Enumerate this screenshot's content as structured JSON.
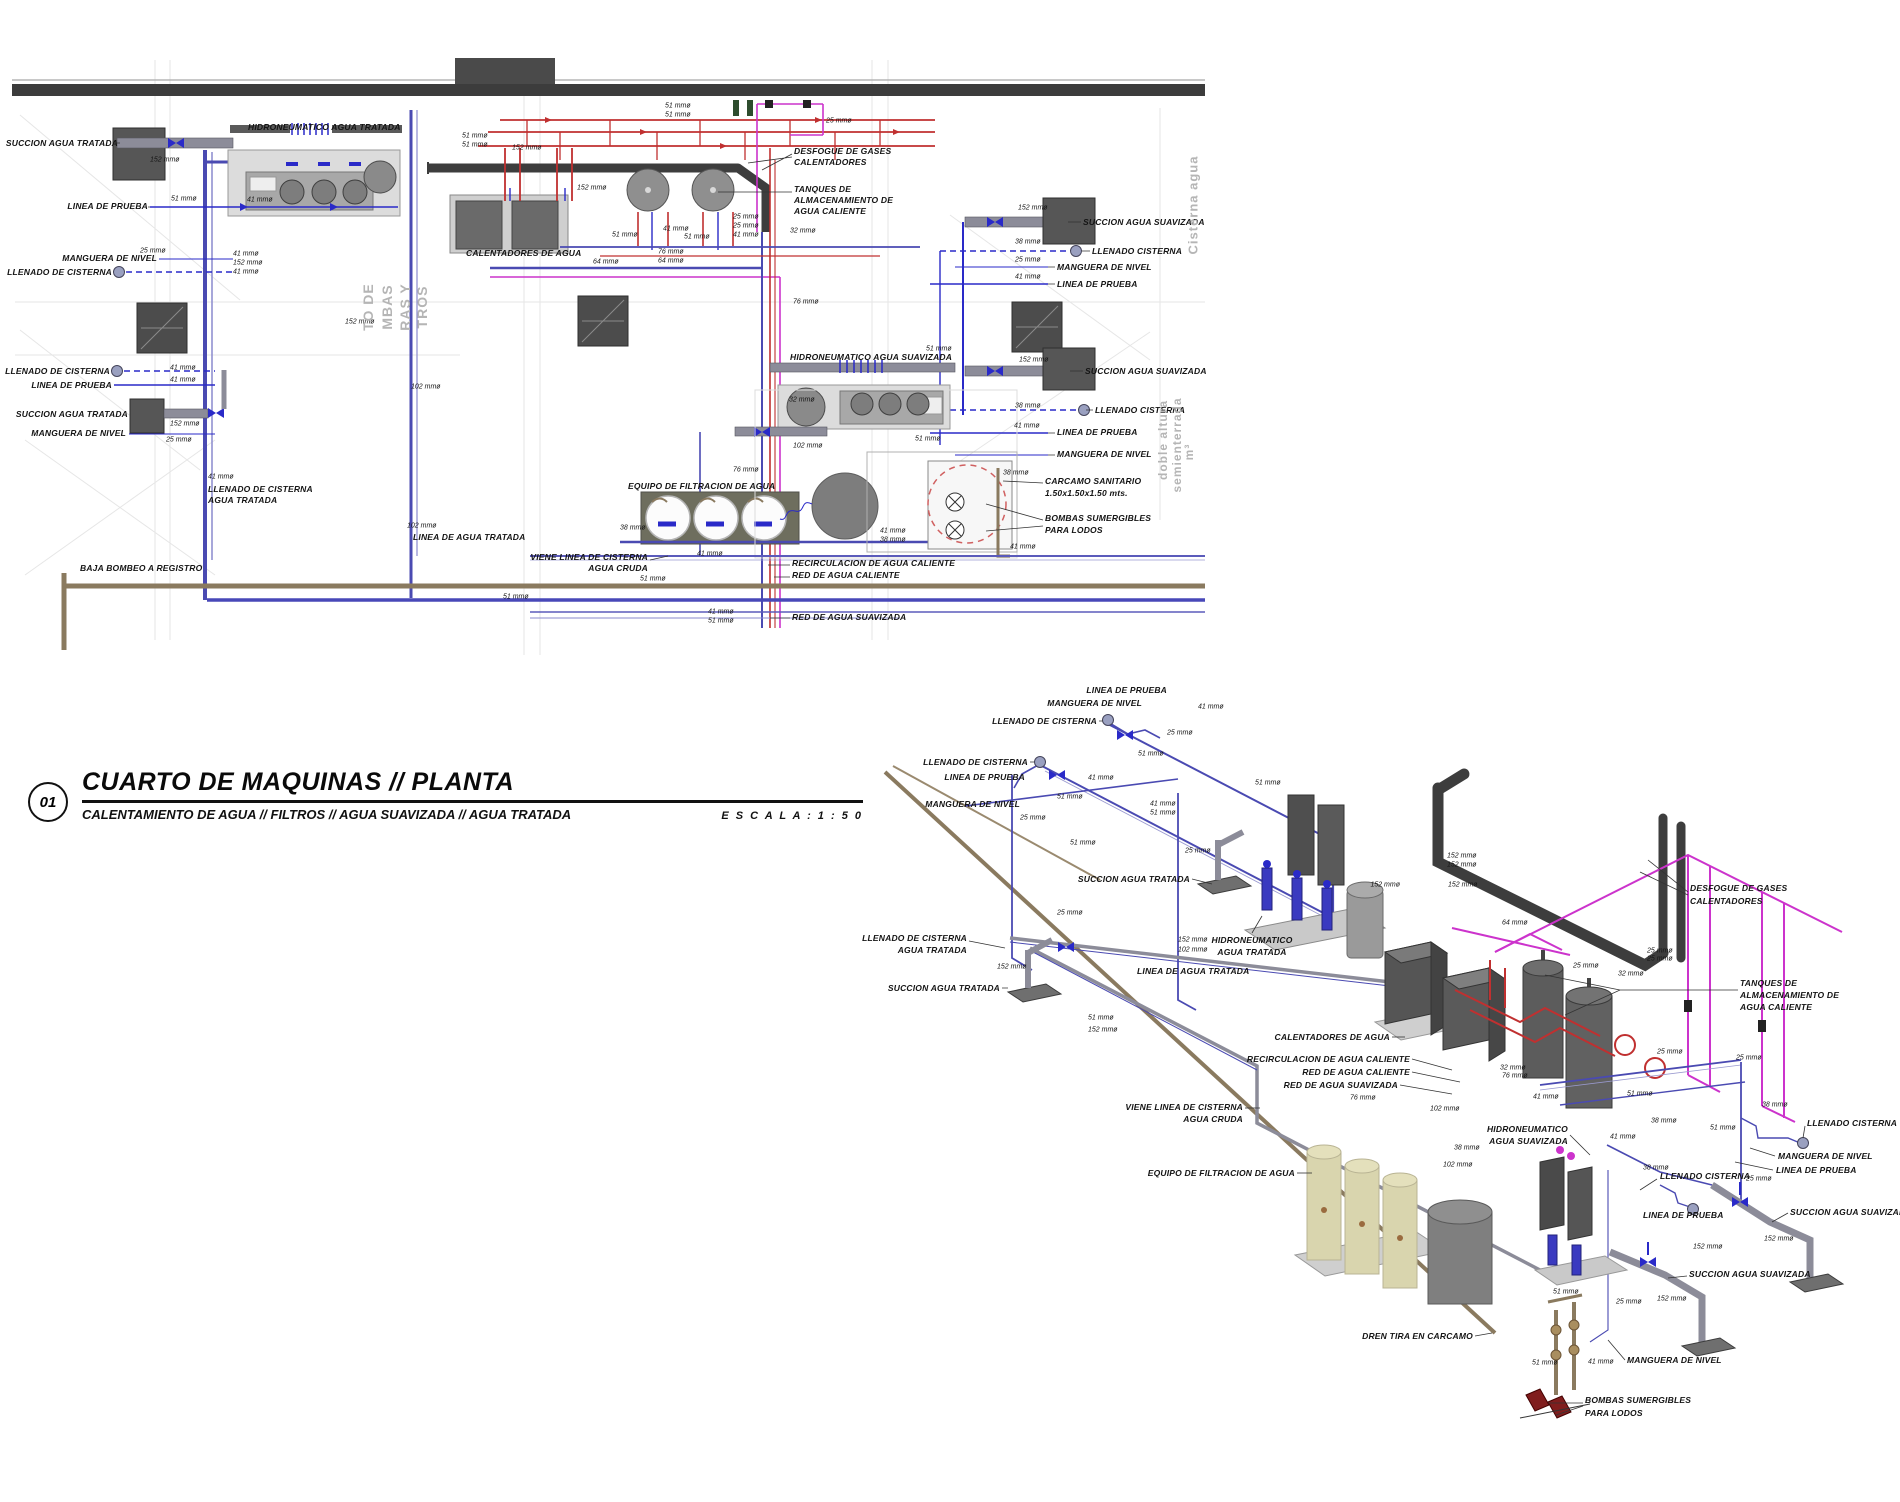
{
  "title_block": {
    "number": "01",
    "title": "CUARTO DE MAQUINAS  //  PLANTA",
    "subtitle": "CALENTAMIENTO DE AGUA // FILTROS // AGUA SUAVIZADA // AGUA TRATADA",
    "scale_label": "E S C A L A :   1 : 5 0"
  },
  "legend_colors": {
    "cold_water_pipe": "#4a4ab2",
    "hot_water_pipe": "#c03030",
    "hot_water_return_pipe": "#cc33cc",
    "drain_pipe": "#8a7a5f",
    "flue_gas_pipe": "#3d3d3d"
  },
  "plan_view": {
    "labels": [
      {
        "t": "HIDRONEUMATICO AGUA TRATADA",
        "x": 248,
        "y": 127,
        "a": "s"
      },
      {
        "t": "SUCCION AGUA TRATADA",
        "x": 118,
        "y": 143,
        "a": "e"
      },
      {
        "t": "LINEA DE PRUEBA",
        "x": 148,
        "y": 206,
        "a": "e"
      },
      {
        "t": "MANGUERA DE NIVEL",
        "x": 157,
        "y": 258,
        "a": "e"
      },
      {
        "t": "LLENADO DE CISTERNA",
        "x": 112,
        "y": 272,
        "a": "e"
      },
      {
        "t": "LLENADO DE CISTERNA",
        "x": 110,
        "y": 371,
        "a": "e"
      },
      {
        "t": "LINEA DE PRUEBA",
        "x": 112,
        "y": 385,
        "a": "e"
      },
      {
        "t": "SUCCION AGUA TRATADA",
        "x": 128,
        "y": 414,
        "a": "e"
      },
      {
        "t": "MANGUERA DE NIVEL",
        "x": 126,
        "y": 433,
        "a": "e"
      },
      {
        "t": "LLENADO DE CISTERNA",
        "x": 208,
        "y": 489,
        "a": "s"
      },
      {
        "t": "AGUA TRATADA",
        "x": 208,
        "y": 500,
        "a": "s"
      },
      {
        "t": "LINEA DE AGUA TRATADA",
        "x": 413,
        "y": 537,
        "a": "s"
      },
      {
        "t": "BAJA BOMBEO A REGISTRO",
        "x": 80,
        "y": 568,
        "a": "s"
      },
      {
        "t": "CALENTADORES DE AGUA",
        "x": 466,
        "y": 253,
        "a": "s"
      },
      {
        "t": "DESFOGUE DE GASES",
        "x": 794,
        "y": 151,
        "a": "s"
      },
      {
        "t": "CALENTADORES",
        "x": 794,
        "y": 162,
        "a": "s"
      },
      {
        "t": "TANQUES DE",
        "x": 794,
        "y": 189,
        "a": "s"
      },
      {
        "t": "ALMACENAMIENTO DE",
        "x": 794,
        "y": 200,
        "a": "s"
      },
      {
        "t": "AGUA CALIENTE",
        "x": 794,
        "y": 211,
        "a": "s"
      },
      {
        "t": "HIDRONEUMATICO AGUA SUAVIZADA",
        "x": 790,
        "y": 357,
        "a": "s"
      },
      {
        "t": "SUCCION AGUA SUAVIZADA",
        "x": 1083,
        "y": 222,
        "a": "s"
      },
      {
        "t": "LLENADO CISTERNA",
        "x": 1092,
        "y": 251,
        "a": "s"
      },
      {
        "t": "MANGUERA DE NIVEL",
        "x": 1057,
        "y": 267,
        "a": "s"
      },
      {
        "t": "LINEA DE PRUEBA",
        "x": 1057,
        "y": 284,
        "a": "s"
      },
      {
        "t": "SUCCION AGUA SUAVIZADA",
        "x": 1085,
        "y": 371,
        "a": "s"
      },
      {
        "t": "LLENADO CISTERNA",
        "x": 1095,
        "y": 410,
        "a": "s"
      },
      {
        "t": "LINEA DE PRUEBA",
        "x": 1057,
        "y": 432,
        "a": "s"
      },
      {
        "t": "MANGUERA DE NIVEL",
        "x": 1057,
        "y": 454,
        "a": "s"
      },
      {
        "t": "CARCAMO SANITARIO",
        "x": 1045,
        "y": 481,
        "a": "s"
      },
      {
        "t": "1.50x1.50x1.50 mts.",
        "x": 1045,
        "y": 493,
        "a": "s"
      },
      {
        "t": "BOMBAS SUMERGIBLES",
        "x": 1045,
        "y": 518,
        "a": "s"
      },
      {
        "t": "PARA LODOS",
        "x": 1045,
        "y": 530,
        "a": "s"
      },
      {
        "t": "EQUIPO DE FILTRACION DE AGUA",
        "x": 628,
        "y": 486,
        "a": "s"
      },
      {
        "t": "VIENE LINEA DE CISTERNA",
        "x": 648,
        "y": 557,
        "a": "e"
      },
      {
        "t": "AGUA CRUDA",
        "x": 648,
        "y": 568,
        "a": "e"
      },
      {
        "t": "RECIRCULACION DE AGUA CALIENTE",
        "x": 792,
        "y": 563,
        "a": "s"
      },
      {
        "t": "RED DE AGUA CALIENTE",
        "x": 792,
        "y": 575,
        "a": "s"
      },
      {
        "t": "RED DE AGUA SUAVIZADA",
        "x": 792,
        "y": 617,
        "a": "s"
      }
    ],
    "dims": [
      {
        "t": "152 mmø",
        "x": 150,
        "y": 160
      },
      {
        "t": "51 mmø",
        "x": 171,
        "y": 199
      },
      {
        "t": "41 mmø",
        "x": 247,
        "y": 200
      },
      {
        "t": "25 mmø",
        "x": 140,
        "y": 251
      },
      {
        "t": "41 mmø",
        "x": 233,
        "y": 254
      },
      {
        "t": "152 mmø",
        "x": 233,
        "y": 263
      },
      {
        "t": "41 mmø",
        "x": 233,
        "y": 272
      },
      {
        "t": "41 mmø",
        "x": 170,
        "y": 368
      },
      {
        "t": "41 mmø",
        "x": 170,
        "y": 380
      },
      {
        "t": "152 mmø",
        "x": 170,
        "y": 424
      },
      {
        "t": "25 mmø",
        "x": 166,
        "y": 440
      },
      {
        "t": "152 mmø",
        "x": 345,
        "y": 322
      },
      {
        "t": "102 mmø",
        "x": 411,
        "y": 387
      },
      {
        "t": "41 mmø",
        "x": 208,
        "y": 477
      },
      {
        "t": "102 mmø",
        "x": 407,
        "y": 526
      },
      {
        "t": "51 mmø",
        "x": 462,
        "y": 136
      },
      {
        "t": "51 mmø",
        "x": 462,
        "y": 145
      },
      {
        "t": "152 mmø",
        "x": 512,
        "y": 148
      },
      {
        "t": "152 mmø",
        "x": 577,
        "y": 188
      },
      {
        "t": "51 mmø",
        "x": 665,
        "y": 106
      },
      {
        "t": "51 mmø",
        "x": 665,
        "y": 115
      },
      {
        "t": "25 mmø",
        "x": 826,
        "y": 121
      },
      {
        "t": "51 mmø",
        "x": 612,
        "y": 235
      },
      {
        "t": "41 mmø",
        "x": 663,
        "y": 229
      },
      {
        "t": "51 mmø",
        "x": 684,
        "y": 237
      },
      {
        "t": "25 mmø",
        "x": 733,
        "y": 217
      },
      {
        "t": "25 mmø",
        "x": 733,
        "y": 226
      },
      {
        "t": "41 mmø",
        "x": 733,
        "y": 235
      },
      {
        "t": "32 mmø",
        "x": 790,
        "y": 231
      },
      {
        "t": "64 mmø",
        "x": 593,
        "y": 262
      },
      {
        "t": "76 mmø",
        "x": 658,
        "y": 252
      },
      {
        "t": "64 mmø",
        "x": 658,
        "y": 261
      },
      {
        "t": "76 mmø",
        "x": 793,
        "y": 302
      },
      {
        "t": "76 mmø",
        "x": 733,
        "y": 470
      },
      {
        "t": "51 mmø",
        "x": 926,
        "y": 349
      },
      {
        "t": "152 mmø",
        "x": 1018,
        "y": 208
      },
      {
        "t": "38 mmø",
        "x": 1015,
        "y": 242
      },
      {
        "t": "25 mmø",
        "x": 1015,
        "y": 260
      },
      {
        "t": "41 mmø",
        "x": 1015,
        "y": 277
      },
      {
        "t": "152 mmø",
        "x": 1019,
        "y": 360
      },
      {
        "t": "38 mmø",
        "x": 1015,
        "y": 406
      },
      {
        "t": "41 mmø",
        "x": 1014,
        "y": 426
      },
      {
        "t": "32 mmø",
        "x": 789,
        "y": 400
      },
      {
        "t": "102 mmø",
        "x": 793,
        "y": 446
      },
      {
        "t": "51 mmø",
        "x": 915,
        "y": 439
      },
      {
        "t": "38 mmø",
        "x": 1003,
        "y": 473
      },
      {
        "t": "41 mmø",
        "x": 880,
        "y": 531
      },
      {
        "t": "38 mmø",
        "x": 880,
        "y": 540
      },
      {
        "t": "41 mmø",
        "x": 1010,
        "y": 547
      },
      {
        "t": "38 mmø",
        "x": 620,
        "y": 528
      },
      {
        "t": "41 mmø",
        "x": 697,
        "y": 554
      },
      {
        "t": "51 mmø",
        "x": 640,
        "y": 579
      },
      {
        "t": "51 mmø",
        "x": 503,
        "y": 597
      },
      {
        "t": "41 mmø",
        "x": 708,
        "y": 612
      },
      {
        "t": "51 mmø",
        "x": 708,
        "y": 621
      }
    ],
    "room_texts": [
      {
        "t": "TO DE",
        "x": 368,
        "y": 307,
        "r": -90,
        "s": 14
      },
      {
        "t": "MBAS",
        "x": 387,
        "y": 307,
        "r": -90,
        "s": 14
      },
      {
        "t": "RAS Y",
        "x": 405,
        "y": 307,
        "r": -90,
        "s": 14
      },
      {
        "t": "TROS",
        "x": 422,
        "y": 307,
        "r": -90,
        "s": 14
      },
      {
        "t": "Cisterna agua",
        "x": 1193,
        "y": 205,
        "r": -90,
        "s": 13
      },
      {
        "t": "doble altura",
        "x": 1163,
        "y": 440,
        "r": -90,
        "s": 12
      },
      {
        "t": "semienterrada",
        "x": 1177,
        "y": 445,
        "r": -90,
        "s": 12
      },
      {
        "t": "m³",
        "x": 1189,
        "y": 452,
        "r": -90,
        "s": 12
      }
    ]
  },
  "iso_view": {
    "labels": [
      {
        "t": "LINEA DE PRUEBA",
        "x": 1167,
        "y": 690,
        "a": "e"
      },
      {
        "t": "MANGUERA DE NIVEL",
        "x": 1142,
        "y": 703,
        "a": "e"
      },
      {
        "t": "LLENADO DE CISTERNA",
        "x": 1097,
        "y": 721,
        "a": "e"
      },
      {
        "t": "LLENADO DE CISTERNA",
        "x": 1028,
        "y": 762,
        "a": "e"
      },
      {
        "t": "LINEA DE PRUEBA",
        "x": 1025,
        "y": 777,
        "a": "e"
      },
      {
        "t": "MANGUERA DE NIVEL",
        "x": 1020,
        "y": 804,
        "a": "e"
      },
      {
        "t": "SUCCION AGUA TRATADA",
        "x": 1190,
        "y": 879,
        "a": "e"
      },
      {
        "t": "HIDRONEUMATICO",
        "x": 1252,
        "y": 940,
        "a": "c"
      },
      {
        "t": "AGUA TRATADA",
        "x": 1252,
        "y": 952,
        "a": "c"
      },
      {
        "t": "LLENADO DE CISTERNA",
        "x": 967,
        "y": 938,
        "a": "e"
      },
      {
        "t": "AGUA TRATADA",
        "x": 967,
        "y": 950,
        "a": "e"
      },
      {
        "t": "SUCCION AGUA TRATADA",
        "x": 1000,
        "y": 988,
        "a": "e"
      },
      {
        "t": "LINEA DE AGUA TRATADA",
        "x": 1137,
        "y": 971,
        "a": "s"
      },
      {
        "t": "DESFOGUE DE GASES",
        "x": 1690,
        "y": 888,
        "a": "s"
      },
      {
        "t": "CALENTADORES",
        "x": 1690,
        "y": 901,
        "a": "s"
      },
      {
        "t": "TANQUES DE",
        "x": 1740,
        "y": 983,
        "a": "s"
      },
      {
        "t": "ALMACENAMIENTO DE",
        "x": 1740,
        "y": 995,
        "a": "s"
      },
      {
        "t": "AGUA CALIENTE",
        "x": 1740,
        "y": 1007,
        "a": "s"
      },
      {
        "t": "CALENTADORES DE AGUA",
        "x": 1390,
        "y": 1037,
        "a": "e"
      },
      {
        "t": "RECIRCULACION DE AGUA CALIENTE",
        "x": 1410,
        "y": 1059,
        "a": "e"
      },
      {
        "t": "RED DE AGUA CALIENTE",
        "x": 1410,
        "y": 1072,
        "a": "e"
      },
      {
        "t": "RED DE AGUA SUAVIZADA",
        "x": 1398,
        "y": 1085,
        "a": "e"
      },
      {
        "t": "VIENE LINEA DE CISTERNA",
        "x": 1243,
        "y": 1107,
        "a": "e"
      },
      {
        "t": "AGUA CRUDA",
        "x": 1243,
        "y": 1119,
        "a": "e"
      },
      {
        "t": "EQUIPO DE FILTRACION DE AGUA",
        "x": 1295,
        "y": 1173,
        "a": "e"
      },
      {
        "t": "HIDRONEUMATICO",
        "x": 1568,
        "y": 1129,
        "a": "e"
      },
      {
        "t": "AGUA SUAVIZADA",
        "x": 1568,
        "y": 1141,
        "a": "e"
      },
      {
        "t": "LLENADO CISTERNA",
        "x": 1807,
        "y": 1123,
        "a": "s"
      },
      {
        "t": "MANGUERA DE NIVEL",
        "x": 1778,
        "y": 1156,
        "a": "s"
      },
      {
        "t": "LINEA DE PRUEBA",
        "x": 1776,
        "y": 1170,
        "a": "s"
      },
      {
        "t": "LLENADO CISTERNA",
        "x": 1660,
        "y": 1176,
        "a": "s"
      },
      {
        "t": "LINEA DE PRUEBA",
        "x": 1643,
        "y": 1215,
        "a": "s"
      },
      {
        "t": "SUCCION AGUA SUAVIZADA",
        "x": 1790,
        "y": 1212,
        "a": "s"
      },
      {
        "t": "SUCCION AGUA SUAVIZADA",
        "x": 1689,
        "y": 1274,
        "a": "s"
      },
      {
        "t": "MANGUERA DE NIVEL",
        "x": 1627,
        "y": 1360,
        "a": "s"
      },
      {
        "t": "DREN TIRA EN CARCAMO",
        "x": 1473,
        "y": 1336,
        "a": "e"
      },
      {
        "t": "BOMBAS SUMERGIBLES",
        "x": 1585,
        "y": 1400,
        "a": "s"
      },
      {
        "t": "PARA LODOS",
        "x": 1585,
        "y": 1413,
        "a": "s"
      }
    ],
    "dims": [
      {
        "t": "41 mmø",
        "x": 1198,
        "y": 707
      },
      {
        "t": "25 mmø",
        "x": 1167,
        "y": 733
      },
      {
        "t": "51 mmø",
        "x": 1138,
        "y": 754
      },
      {
        "t": "41 mmø",
        "x": 1088,
        "y": 778
      },
      {
        "t": "51 mmø",
        "x": 1057,
        "y": 797
      },
      {
        "t": "41 mmø",
        "x": 1150,
        "y": 804
      },
      {
        "t": "51 mmø",
        "x": 1150,
        "y": 813
      },
      {
        "t": "25 mmø",
        "x": 1020,
        "y": 818
      },
      {
        "t": "51 mmø",
        "x": 1070,
        "y": 843
      },
      {
        "t": "25 mmø",
        "x": 1185,
        "y": 851
      },
      {
        "t": "51 mmø",
        "x": 1255,
        "y": 783
      },
      {
        "t": "25 mmø",
        "x": 1057,
        "y": 913
      },
      {
        "t": "152 mmø",
        "x": 1178,
        "y": 940
      },
      {
        "t": "102 mmø",
        "x": 1178,
        "y": 950
      },
      {
        "t": "152 mmø",
        "x": 997,
        "y": 967
      },
      {
        "t": "51 mmø",
        "x": 1088,
        "y": 1018
      },
      {
        "t": "152 mmø",
        "x": 1088,
        "y": 1030
      },
      {
        "t": "152 mmø",
        "x": 1447,
        "y": 856
      },
      {
        "t": "152 mmø",
        "x": 1447,
        "y": 865
      },
      {
        "t": "152 mmø",
        "x": 1400,
        "y": 885,
        "a": "e"
      },
      {
        "t": "152 mmø",
        "x": 1448,
        "y": 885
      },
      {
        "t": "64 mmø",
        "x": 1502,
        "y": 923
      },
      {
        "t": "25 mmø",
        "x": 1573,
        "y": 966
      },
      {
        "t": "32 mmø",
        "x": 1618,
        "y": 974
      },
      {
        "t": "25 mmø",
        "x": 1647,
        "y": 951
      },
      {
        "t": "25 mmø",
        "x": 1647,
        "y": 959
      },
      {
        "t": "25 mmø",
        "x": 1657,
        "y": 1052
      },
      {
        "t": "25 mmø",
        "x": 1736,
        "y": 1058
      },
      {
        "t": "32 mmø",
        "x": 1500,
        "y": 1068
      },
      {
        "t": "76 mmø",
        "x": 1502,
        "y": 1076
      },
      {
        "t": "41 mmø",
        "x": 1533,
        "y": 1097
      },
      {
        "t": "51 mmø",
        "x": 1627,
        "y": 1094
      },
      {
        "t": "38 mmø",
        "x": 1762,
        "y": 1105
      },
      {
        "t": "76 mmø",
        "x": 1350,
        "y": 1098
      },
      {
        "t": "102 mmø",
        "x": 1430,
        "y": 1109
      },
      {
        "t": "38 mmø",
        "x": 1454,
        "y": 1148
      },
      {
        "t": "102 mmø",
        "x": 1443,
        "y": 1165
      },
      {
        "t": "38 mmø",
        "x": 1651,
        "y": 1121
      },
      {
        "t": "51 mmø",
        "x": 1710,
        "y": 1128
      },
      {
        "t": "41 mmø",
        "x": 1610,
        "y": 1137
      },
      {
        "t": "38 mmø",
        "x": 1643,
        "y": 1168
      },
      {
        "t": "25 mmø",
        "x": 1746,
        "y": 1179
      },
      {
        "t": "152 mmø",
        "x": 1693,
        "y": 1247
      },
      {
        "t": "152 mmø",
        "x": 1764,
        "y": 1239
      },
      {
        "t": "152 mmø",
        "x": 1657,
        "y": 1299
      },
      {
        "t": "25 mmø",
        "x": 1616,
        "y": 1302
      },
      {
        "t": "51 mmø",
        "x": 1553,
        "y": 1292
      },
      {
        "t": "51 mmø",
        "x": 1532,
        "y": 1363
      },
      {
        "t": "41 mmø",
        "x": 1588,
        "y": 1362
      }
    ]
  }
}
